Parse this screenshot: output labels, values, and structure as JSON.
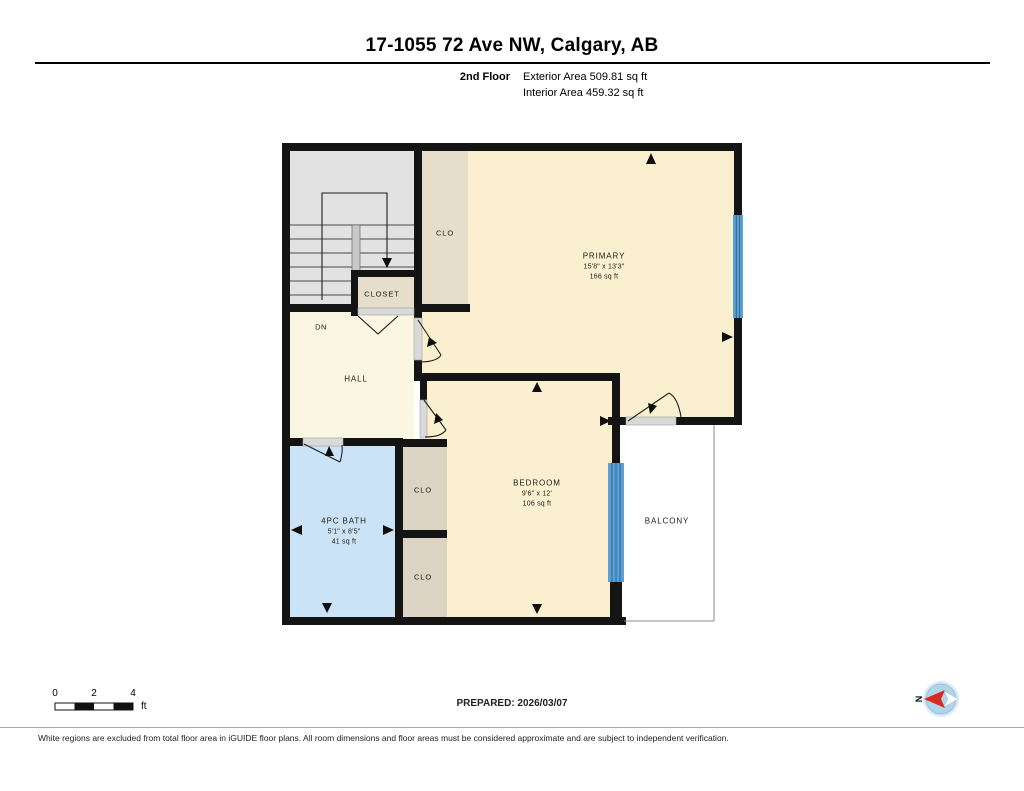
{
  "header": {
    "title": "17-1055 72 Ave NW, Calgary, AB",
    "floor_label": "2nd Floor",
    "exterior_area": "Exterior Area 509.81 sq ft",
    "interior_area": "Interior Area 459.32 sq ft"
  },
  "rooms": {
    "primary": {
      "name": "PRIMARY",
      "dims": "15'8\" x 13'3\"",
      "area": "166 sq ft"
    },
    "bedroom": {
      "name": "BEDROOM",
      "dims": "9'6\" x 12'",
      "area": "106 sq ft"
    },
    "bath": {
      "name": "4PC BATH",
      "dims": "5'1\" x 8'5\"",
      "area": "41 sq ft"
    },
    "hall": {
      "name": "HALL"
    },
    "closet": {
      "name": "CLOSET"
    },
    "clo_strip": {
      "name": "CLO"
    },
    "clo_upper": {
      "name": "CLO"
    },
    "clo_lower": {
      "name": "CLO"
    },
    "balcony": {
      "name": "BALCONY"
    },
    "stairs_dn": "DN"
  },
  "footer": {
    "scale": {
      "zero": "0",
      "two": "2",
      "four": "4",
      "unit": "ft"
    },
    "prepared": "PREPARED: 2026/03/07",
    "compass_north": "N",
    "disclaimer": "White regions are excluded from total floor area in iGUIDE floor plans. All room dimensions and floor areas must be considered approximate and are subject to independent verification."
  },
  "colors": {
    "wall": "#141414",
    "room_cream": "#FAEFCF",
    "room_cream_light": "#FAF6E2",
    "closet_tan": "#E6DDCA",
    "closet_tan_dark": "#DCD4C2",
    "stairs_gray": "#E2E2E2",
    "bath_blue": "#CBE3F6",
    "window_blue": "#5C9FD0",
    "window_line": "#2A6697",
    "threshold_gray": "#D9D9D9",
    "compass_blue": "#AFD5EA",
    "compass_red": "#D42B1E"
  }
}
